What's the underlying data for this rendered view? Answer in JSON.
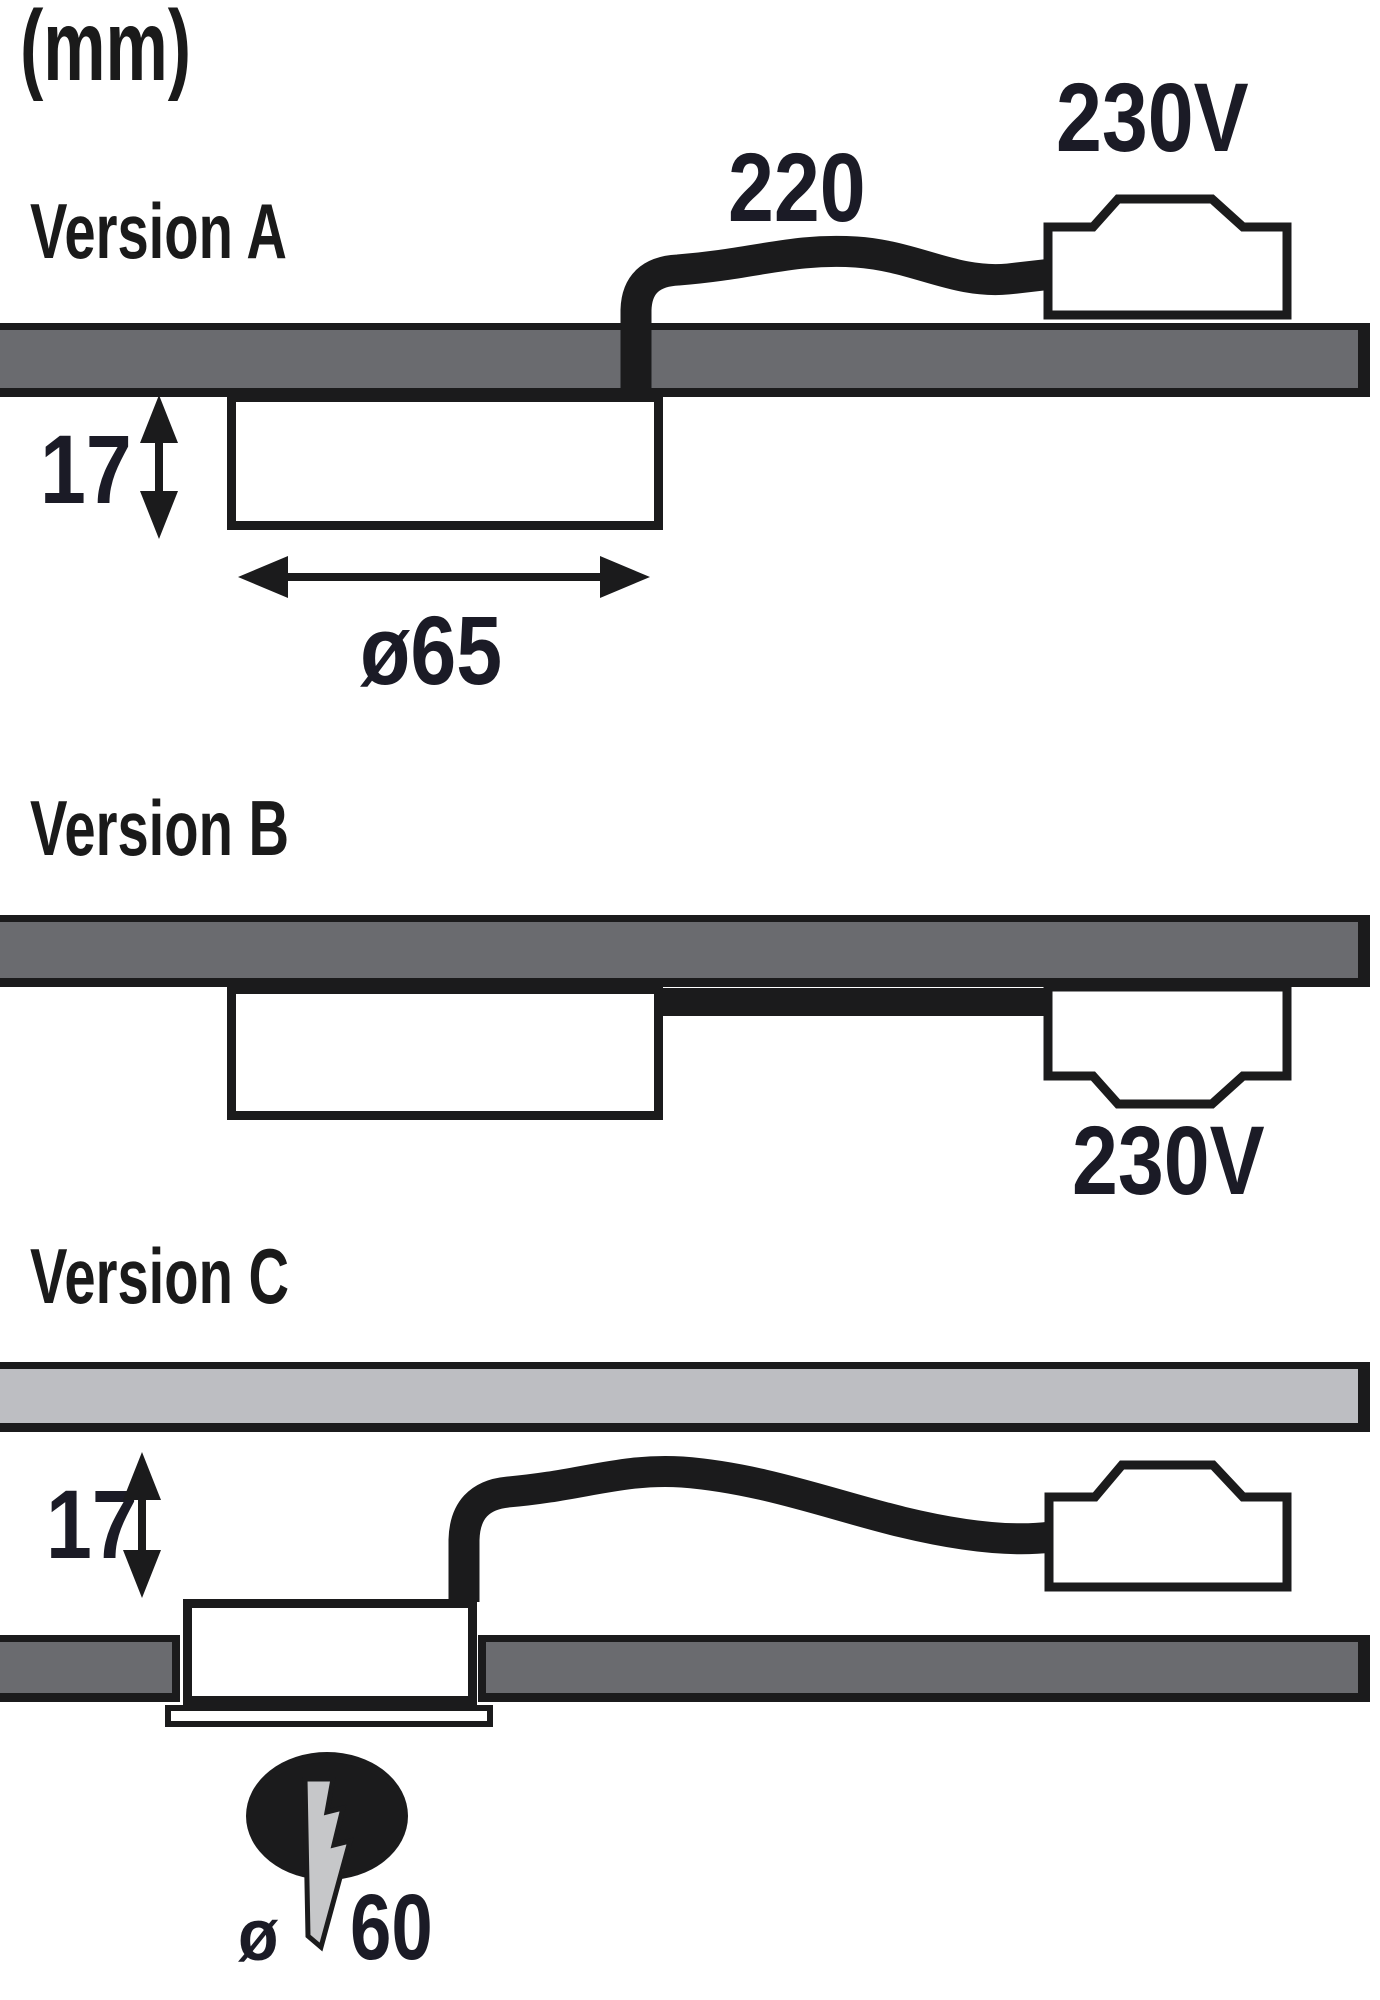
{
  "unit_label": "(mm)",
  "colors": {
    "ink": "#1b1b1c",
    "dim_text": "#1b1b26",
    "board_dark": "#6a6b6f",
    "panel_light": "#bdbec2",
    "bolt_gray": "#c6c7c9",
    "white": "#ffffff"
  },
  "version_a": {
    "label": "Version A",
    "cable_length": "220",
    "supply_voltage": "230V",
    "recess_depth": "17",
    "diameter": "≥65",
    "diameter_text": "ø65"
  },
  "version_b": {
    "label": "Version B",
    "supply_voltage": "230V"
  },
  "version_c": {
    "label": "Version C",
    "recess_depth": "17",
    "hole_symbol": "ø",
    "hole_diameter": "60"
  }
}
